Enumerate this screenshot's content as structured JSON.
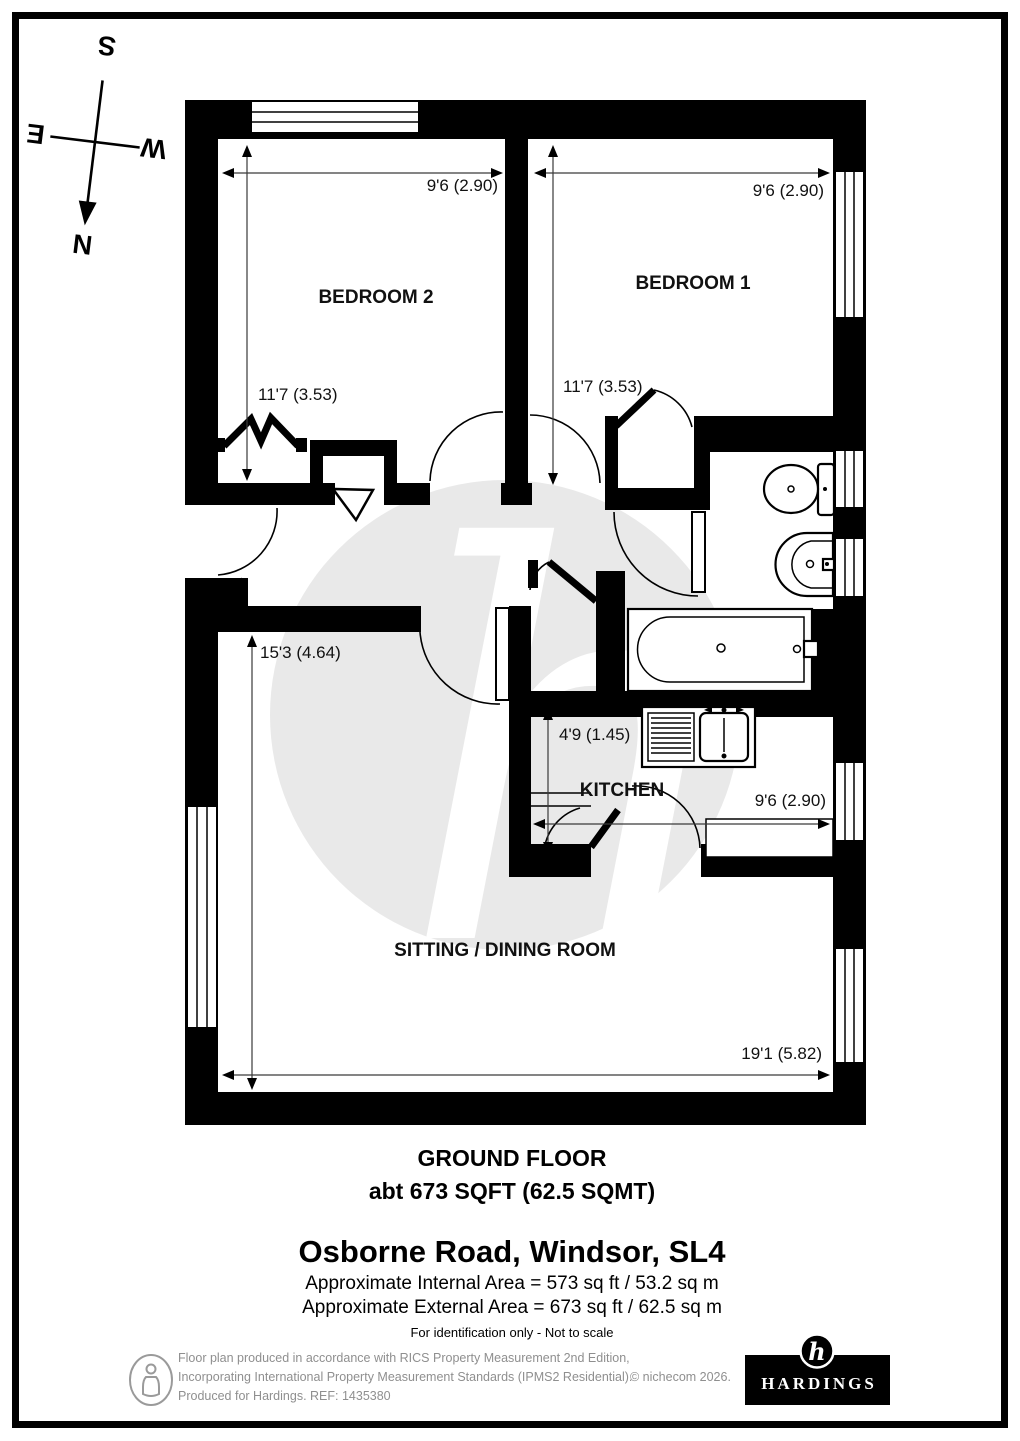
{
  "compass": {
    "n": "N",
    "s": "S",
    "e": "E",
    "w": "W"
  },
  "plan": {
    "rooms": {
      "bedroom2": {
        "name": "BEDROOM 2",
        "width": "9'6 (2.90)",
        "depth": "11'7 (3.53)"
      },
      "bedroom1": {
        "name": "BEDROOM 1",
        "width": "9'6 (2.90)",
        "depth": "11'7 (3.53)"
      },
      "kitchen": {
        "name": "KITCHEN",
        "width": "9'6 (2.90)",
        "depth": "4'9 (1.45)"
      },
      "sitting": {
        "name": "SITTING / DINING ROOM",
        "width": "19'1 (5.82)",
        "depth": "15'3 (4.64)"
      }
    },
    "watermark_letter": "h"
  },
  "summary": {
    "floor": "GROUND FLOOR",
    "area": "abt 673 SQFT (62.5 SQMT)"
  },
  "property": {
    "title": "Osborne Road, Windsor, SL4",
    "internal_area": "Approximate Internal Area = 573 sq ft / 53.2 sq m",
    "external_area": "Approximate External Area = 673 sq ft / 62.5 sq m",
    "identification": "For identification only - Not to scale"
  },
  "footer": {
    "line1": "Floor plan produced in accordance with RICS Property Measurement 2nd Edition,",
    "line2": "Incorporating International Property Measurement Standards (IPMS2 Residential).",
    "copyright": "© nichecom 2026.",
    "line3": "Produced for Hardings.   REF:  1435380",
    "brand": "HARDINGS",
    "brand_monogram": "h"
  },
  "colors": {
    "wall": "#000000",
    "watermark": "#e9e9e9",
    "dim_line": "#3a3a3a",
    "footer_text": "#8f8f8f",
    "brand_bg": "#000000",
    "brand_fg": "#ffffff"
  }
}
